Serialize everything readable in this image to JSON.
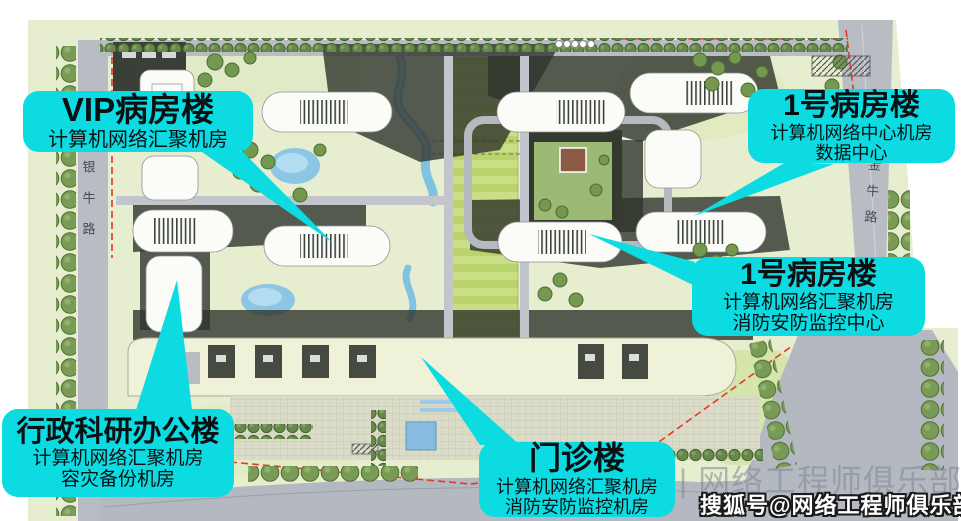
{
  "map": {
    "left_road": "银牛路",
    "right_road": "金牛路"
  },
  "callouts": [
    {
      "id": "vip-ward-building",
      "title": "VIP病房楼",
      "lines": [
        "计算机网络汇聚机房"
      ]
    },
    {
      "id": "ward1-top",
      "title": "1号病房楼",
      "lines": [
        "计算机网络中心机房",
        "数据中心"
      ]
    },
    {
      "id": "ward1-mid",
      "title": "1号病房楼",
      "lines": [
        "计算机网络汇聚机房",
        "消防安防监控中心"
      ]
    },
    {
      "id": "admin-research",
      "title": "行政科研办公楼",
      "lines": [
        "计算机网络汇聚机房",
        "容灾备份机房"
      ]
    },
    {
      "id": "outpatient",
      "title": "门诊楼",
      "lines": [
        "计算机网络汇聚机房",
        "消防安防监控机房"
      ]
    }
  ],
  "watermarks": {
    "faint": "公众号 | 网络工程师俱乐部",
    "bold": "搜狐号@网络工程师俱乐部"
  },
  "colors": {
    "callout_bg": "#0cdce2",
    "callout_text": "#0b1013",
    "map_ground": "#e7eecf",
    "road_gray": "#b9bdc3",
    "boundary_red": "#e23a28",
    "water_blue": "#8cc6e4",
    "axis_green": "#c6df7a"
  }
}
